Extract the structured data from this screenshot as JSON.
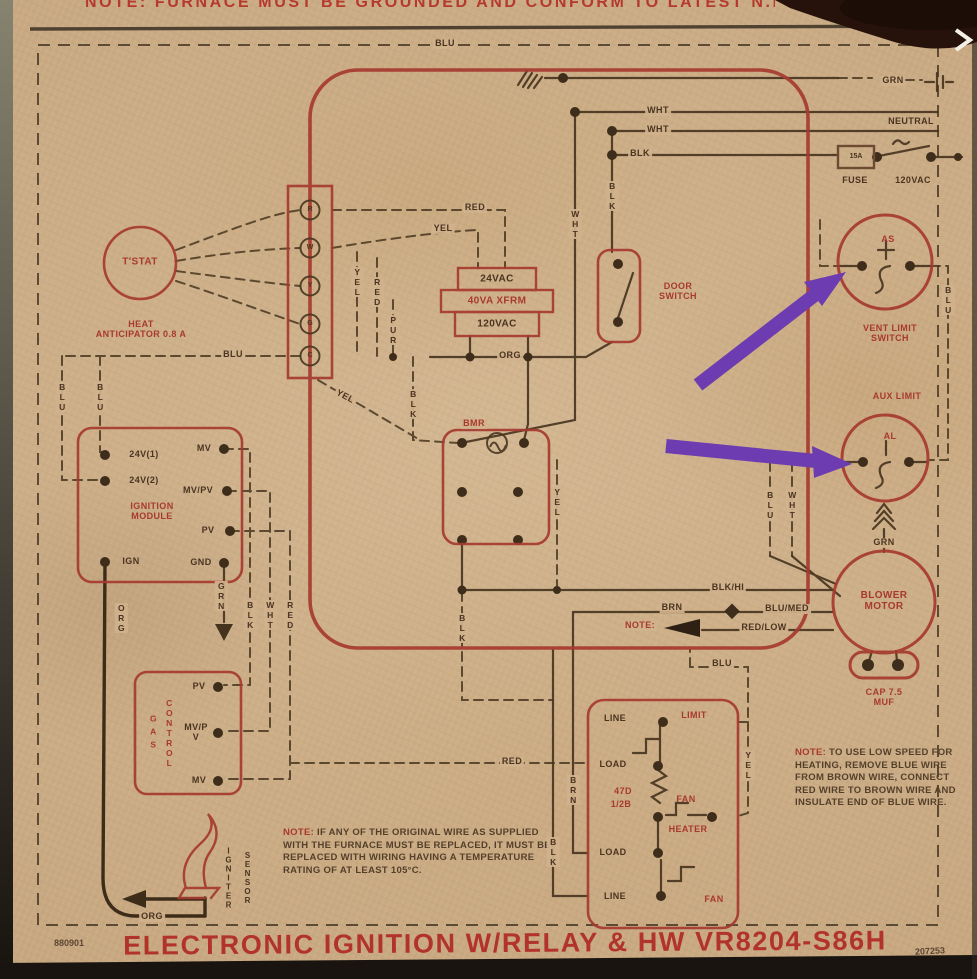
{
  "meta": {
    "top_note": "NOTE: FURNACE MUST BE GROUNDED AND CONFORM TO LATEST N.E.C.",
    "title": "ELECTRONIC IGNITION W/RELAY & HW VR8204-S86H",
    "code_left": "880901",
    "code_right": "207253"
  },
  "colors": {
    "ink": "#4a3420",
    "red": "#a83a2d",
    "purple": "#6d3cb0",
    "paper": "#cfae87"
  },
  "tstat": {
    "label": "T'STAT",
    "sub": "HEAT ANTICIPATOR 0.8 A"
  },
  "terminal_strip": {
    "terminals": [
      "R",
      "W",
      "Y",
      "G",
      "C"
    ]
  },
  "transformer": {
    "top": "24VAC",
    "mid": "40VA XFRM",
    "bottom": "120VAC"
  },
  "door_switch": {
    "label": "DOOR SWITCH"
  },
  "relay": {
    "label": "BMR"
  },
  "ignition_module": {
    "title": "IGNITION MODULE",
    "left": [
      "24V(1)",
      "24V(2)",
      "IGN"
    ],
    "right": [
      "MV",
      "MV/PV",
      "PV",
      "GND"
    ]
  },
  "gas_control": {
    "word1": "GAS",
    "word2": "CONTROL",
    "terminals": [
      "PV",
      "MV/PV",
      "MV"
    ]
  },
  "fan_control": {
    "line_top": "LINE",
    "limit": "LIMIT",
    "load_top": "LOAD",
    "coil1": "47D",
    "coil2": "1/2B",
    "fan_mid": "FAN",
    "heater": "HEATER",
    "load_bottom": "LOAD",
    "line_bottom": "LINE",
    "fan_bottom": "FAN"
  },
  "power": {
    "amp": "15A",
    "fuse": "FUSE",
    "voltage": "120VAC",
    "neutral": "NEUTRAL"
  },
  "vent_limit": {
    "code": "AS",
    "label": "VENT LIMIT SWITCH"
  },
  "aux_limit": {
    "code": "AL",
    "label": "AUX LIMIT"
  },
  "blower": {
    "label": "BLOWER MOTOR",
    "cap": "CAP 7.5 MUF"
  },
  "igniter": {
    "word1": "IGNITER",
    "word2": "SENSOR"
  },
  "notes": {
    "note1_prefix": "NOTE:",
    "note1_body": "IF ANY OF THE ORIGINAL WIRE AS SUPPLIED WITH THE FURNACE MUST BE REPLACED, IT MUST BE REPLACED WITH WIRING HAVING A TEMPERATURE RATING OF AT LEAST 105°C.",
    "note2_prefix": "NOTE:",
    "note2_body": "TO USE LOW SPEED FOR HEATING, REMOVE BLUE WIRE FROM BROWN WIRE, CONNECT RED WIRE TO BROWN WIRE AND INSULATE END OF BLUE WIRE.",
    "note3": "NOTE:"
  },
  "wires": {
    "blu_top": "BLU",
    "grn_top": "GRN",
    "wht_a": "WHT",
    "wht_b": "WHT",
    "blk_a": "BLK",
    "red_a": "RED",
    "yel_a": "YEL",
    "yel_v1": "YEL",
    "red_v1": "RED",
    "pur_v": "PUR",
    "wht_v1": "WHT",
    "blk_v1": "BLK",
    "org_a": "ORG",
    "blu_b": "BLU",
    "blu_v1": "BLU",
    "blu_v2": "BLU",
    "yel_diag": "YEL",
    "blk_v2": "BLK",
    "yel_v2": "YEL",
    "blk_v3": "BLK",
    "grn_v1": "GRN",
    "blk_v4": "BLK",
    "wht_v2": "WHT",
    "red_v2": "RED",
    "org_v1": "ORG",
    "blk_hi": "BLK/HI",
    "brn_a": "BRN",
    "blu_med": "BLU/MED",
    "red_low": "RED/LOW",
    "blu_c": "BLU",
    "yel_v3": "YEL",
    "red_b": "RED",
    "brn_v1": "BRN",
    "blk_v5": "BLK",
    "blu_v3": "BLU",
    "wht_v3": "WHT",
    "blu_v4": "BLU",
    "org_b": "ORG",
    "grn_b": "GRN"
  }
}
